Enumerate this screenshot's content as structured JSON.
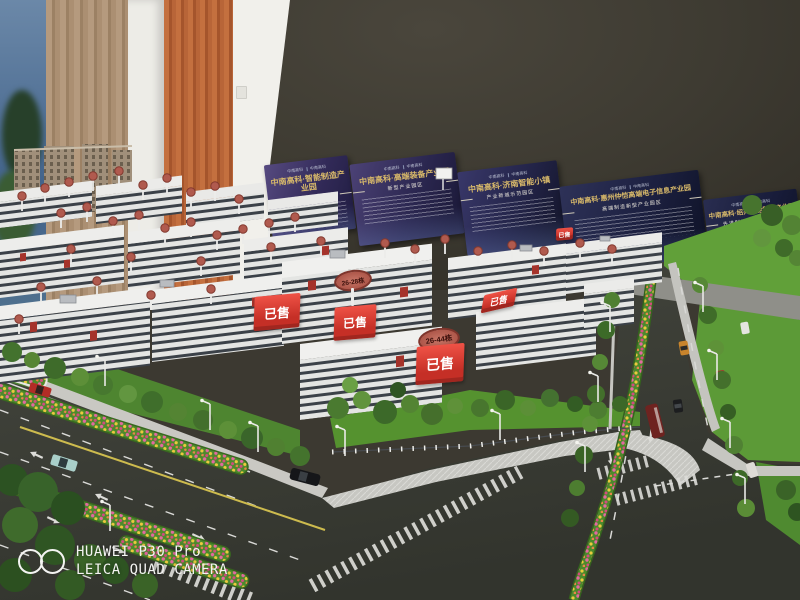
{
  "watermark": {
    "device": "HUAWEI P30 Pro",
    "camera": "LEICA QUAD CAMERA"
  },
  "boards": {
    "logo_text": "中南高科",
    "items": [
      {
        "title": "中南高科·智能制造产业园",
        "subtitle": "高端制造产业园区"
      },
      {
        "title": "中南高科·高端装备产业园",
        "subtitle": "新型产业园区"
      },
      {
        "title": "中南高科·济南智能小镇",
        "subtitle": "产业新城示范园区"
      },
      {
        "title": "中南高科·惠州仲恺高端电子信息产业园",
        "subtitle": "高端制造新型产业园区"
      },
      {
        "title": "中南高科·绍兴智能制造产业园",
        "subtitle": "先进制造新型产业园区"
      }
    ]
  },
  "signs": {
    "sold": "已售",
    "building_range_a": "26-28栋",
    "building_range_b": "26-44栋"
  },
  "colors": {
    "wall": "#3c3931",
    "board_gold": "#d8b96a",
    "sold_red": "#df392e",
    "asphalt": "#3b3d38",
    "lawn": "#5f9c3a",
    "flower_pink": "#e06a9e",
    "flower_yellow": "#e8c43e",
    "building_white": "#e8e9e7"
  }
}
